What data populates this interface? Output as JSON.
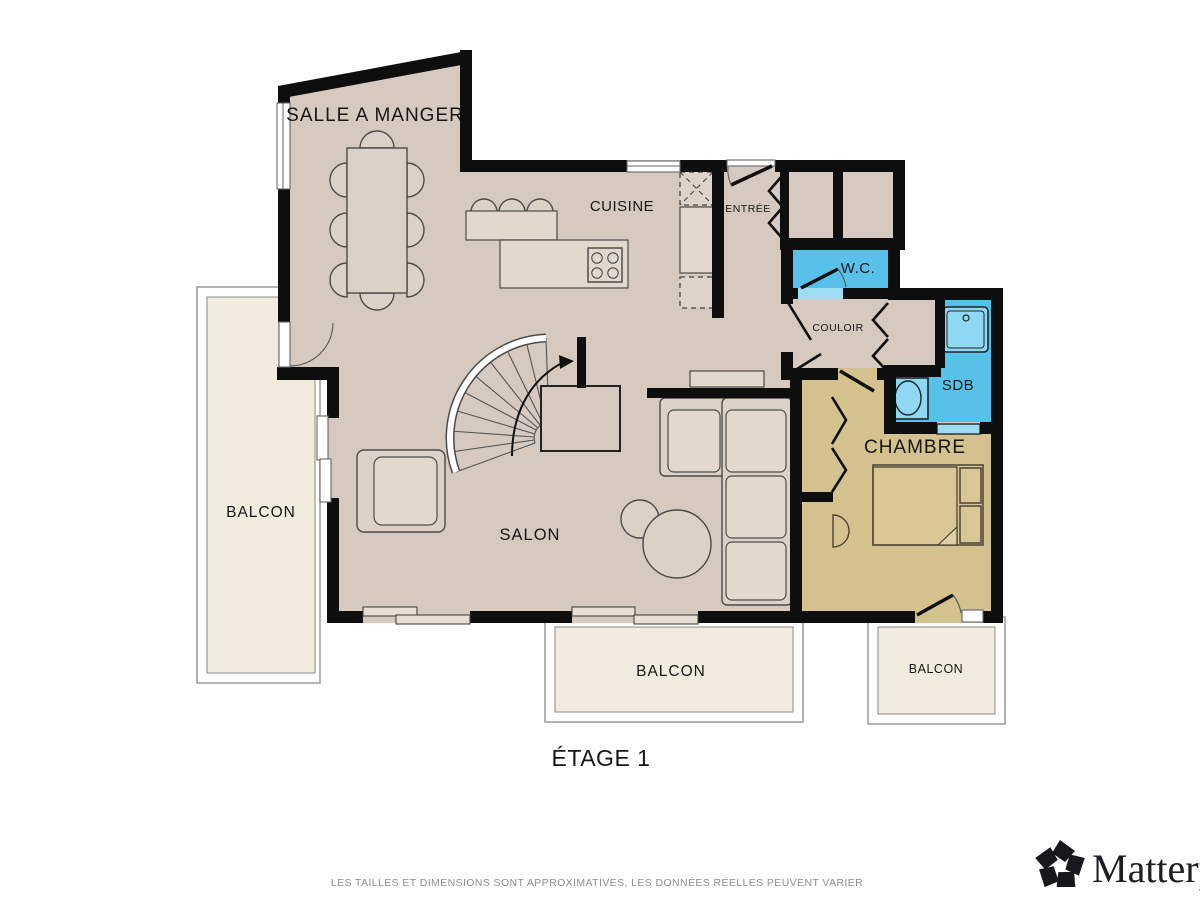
{
  "floor_plan": {
    "title": "ÉTAGE 1",
    "rooms": {
      "dining": {
        "label": "SALLE A MANGER"
      },
      "kitchen": {
        "label": "CUISINE"
      },
      "entry": {
        "label": "ENTRÉE"
      },
      "wc": {
        "label": "W.C."
      },
      "hallway": {
        "label": "COULOIR"
      },
      "bathroom": {
        "label": "SDB"
      },
      "bedroom": {
        "label": "CHAMBRE"
      },
      "living_room": {
        "label": "SALON"
      },
      "balcony_left": {
        "label": "BALCON"
      },
      "balcony_center": {
        "label": "BALCON"
      },
      "balcony_right": {
        "label": "BALCON"
      }
    }
  },
  "footer": {
    "disclaimer": "LES TAILLES ET DIMENSIONS SONT APPROXIMATIVES, LES DONNÉES RÉELLES PEUVENT VARIER"
  },
  "branding": {
    "logo_text": "Matterport",
    "logo_icon": "matterport-pinwheel-icon"
  },
  "colors": {
    "wall": "#0e0e0e",
    "floor_main": "#d5c9c0",
    "floor_bedroom": "#d3c28d",
    "floor_balcony": "#f2ecdf",
    "wet_room_blue": "#58c1e9",
    "wet_room_light_blue": "#9edcf4",
    "background": "#ffffff",
    "footer_text": "#8d8d8d"
  }
}
